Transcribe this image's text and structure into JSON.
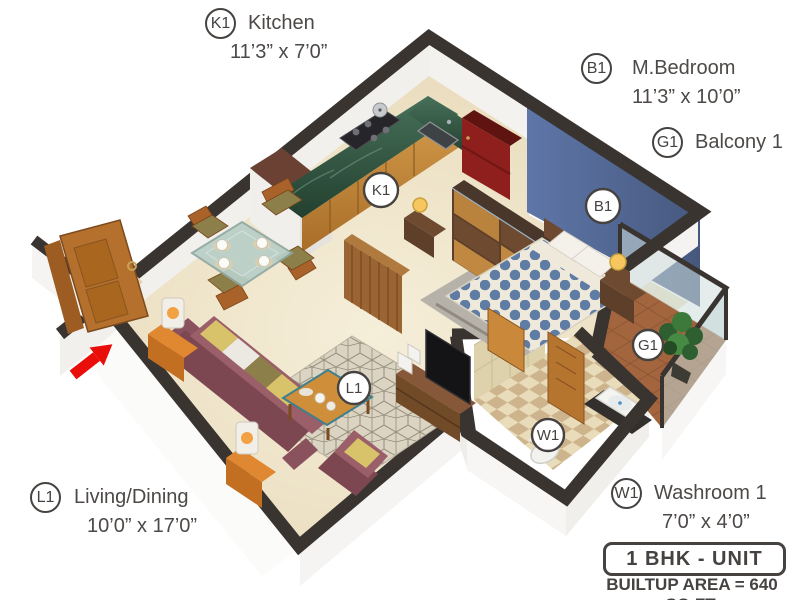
{
  "unit": {
    "type_label": "1 BHK - UNIT",
    "builtup_label": "BUILTUP AREA = 640 SQ.FT."
  },
  "rooms": {
    "kitchen": {
      "code": "K1",
      "name": "Kitchen",
      "dims": "11’3” x 7’0”"
    },
    "bedroom": {
      "code": "B1",
      "name": "M.Bedroom",
      "dims": "11’3” x 10’0”"
    },
    "balcony": {
      "code": "G1",
      "name": "Balcony 1",
      "dims": ""
    },
    "living": {
      "code": "L1",
      "name": "Living/Dining",
      "dims": "10’0” x 17’0”"
    },
    "washroom": {
      "code": "W1",
      "name": "Washroom 1",
      "dims": "7’0” x 4’0”"
    }
  },
  "colors": {
    "wall_dark": "#3a3431",
    "accent_wall_blue": "#54699b",
    "floor_beige": "#eee2c6",
    "sofa_maroon": "#9a5f69",
    "counter_green": "#2f4f3e",
    "entry_arrow_red": "#ea0e0a"
  }
}
